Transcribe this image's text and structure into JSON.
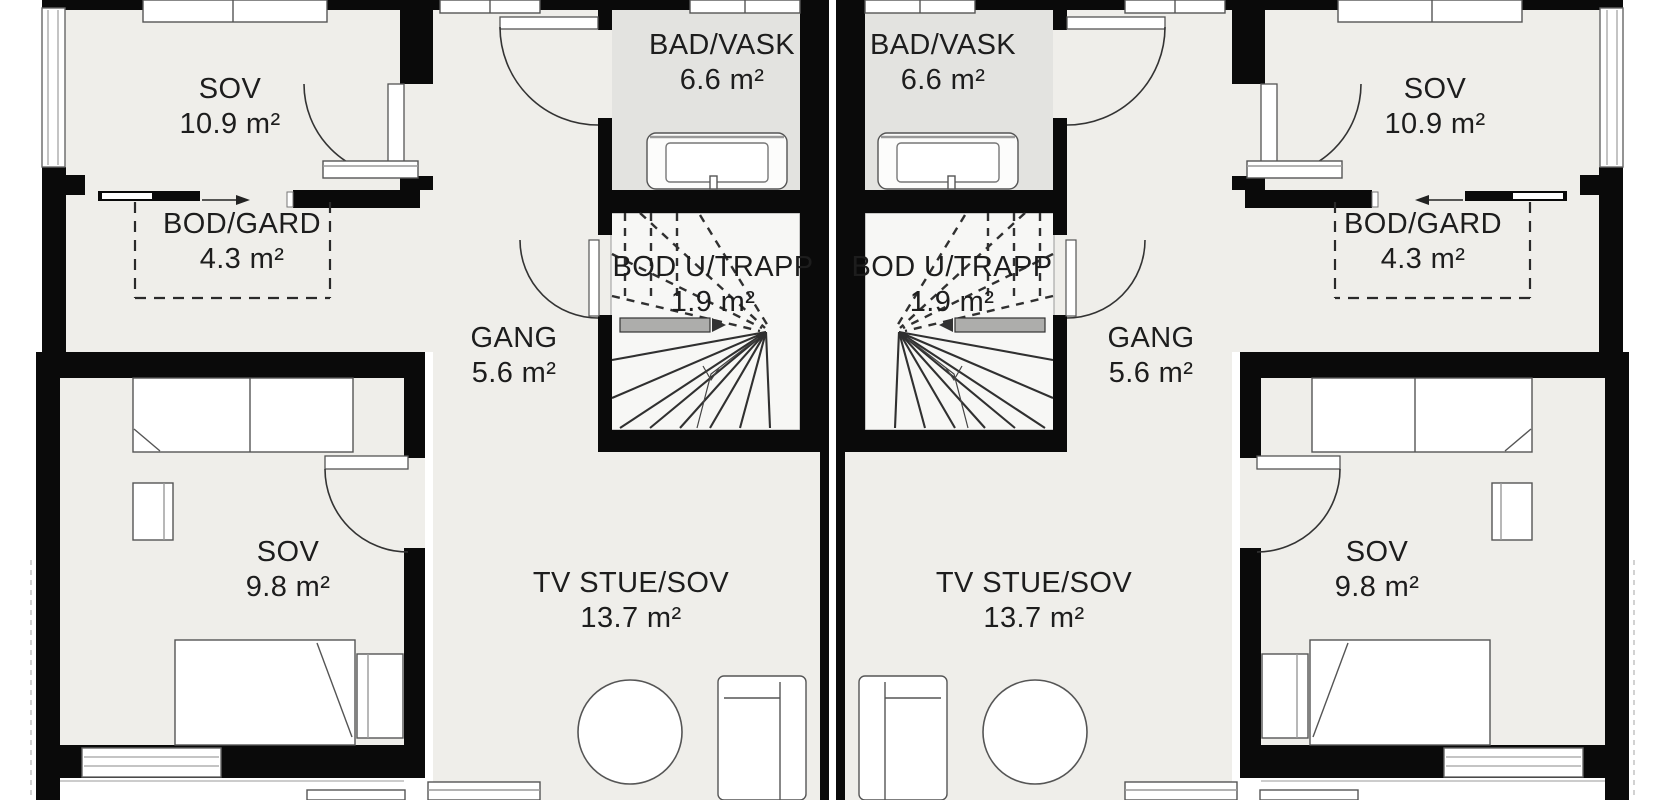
{
  "plan": {
    "description": "Mirrored duplex floor plan, upper storey",
    "units": [
      "left",
      "right"
    ]
  },
  "labels": [
    {
      "id": "left-sov-upper",
      "name": "SOV",
      "area": "10.9 m²"
    },
    {
      "id": "left-bad-vask",
      "name": "BAD/VASK",
      "area": "6.6 m²"
    },
    {
      "id": "left-bod-gard",
      "name": "BOD/GARD",
      "area": "4.3 m²"
    },
    {
      "id": "left-bod-u-trapp",
      "name": "BOD U/TRAPP",
      "area": "1.9 m²"
    },
    {
      "id": "left-gang",
      "name": "GANG",
      "area": "5.6 m²"
    },
    {
      "id": "left-sov-lower",
      "name": "SOV",
      "area": "9.8 m²"
    },
    {
      "id": "left-tv-stue",
      "name": "TV STUE/SOV",
      "area": "13.7 m²"
    },
    {
      "id": "right-sov-upper",
      "name": "SOV",
      "area": "10.9 m²"
    },
    {
      "id": "right-bad-vask",
      "name": "BAD/VASK",
      "area": "6.6 m²"
    },
    {
      "id": "right-bod-gard",
      "name": "BOD/GARD",
      "area": "4.3 m²"
    },
    {
      "id": "right-bod-u-trapp",
      "name": "BOD U/TRAPP",
      "area": "1.9 m²"
    },
    {
      "id": "right-gang",
      "name": "GANG",
      "area": "5.6 m²"
    },
    {
      "id": "right-sov-lower",
      "name": "SOV",
      "area": "9.8 m²"
    },
    {
      "id": "right-tv-stue",
      "name": "TV STUE/SOV",
      "area": "13.7 m²"
    }
  ],
  "colors": {
    "wall": "#0a0a0a",
    "floor": "#efeeea",
    "bathroom_floor": "#e3e3e0",
    "stair_floor": "#f7f7f5",
    "furniture_outline": "#555555",
    "label_text": "#1d1d1d",
    "background": "#ffffff"
  }
}
